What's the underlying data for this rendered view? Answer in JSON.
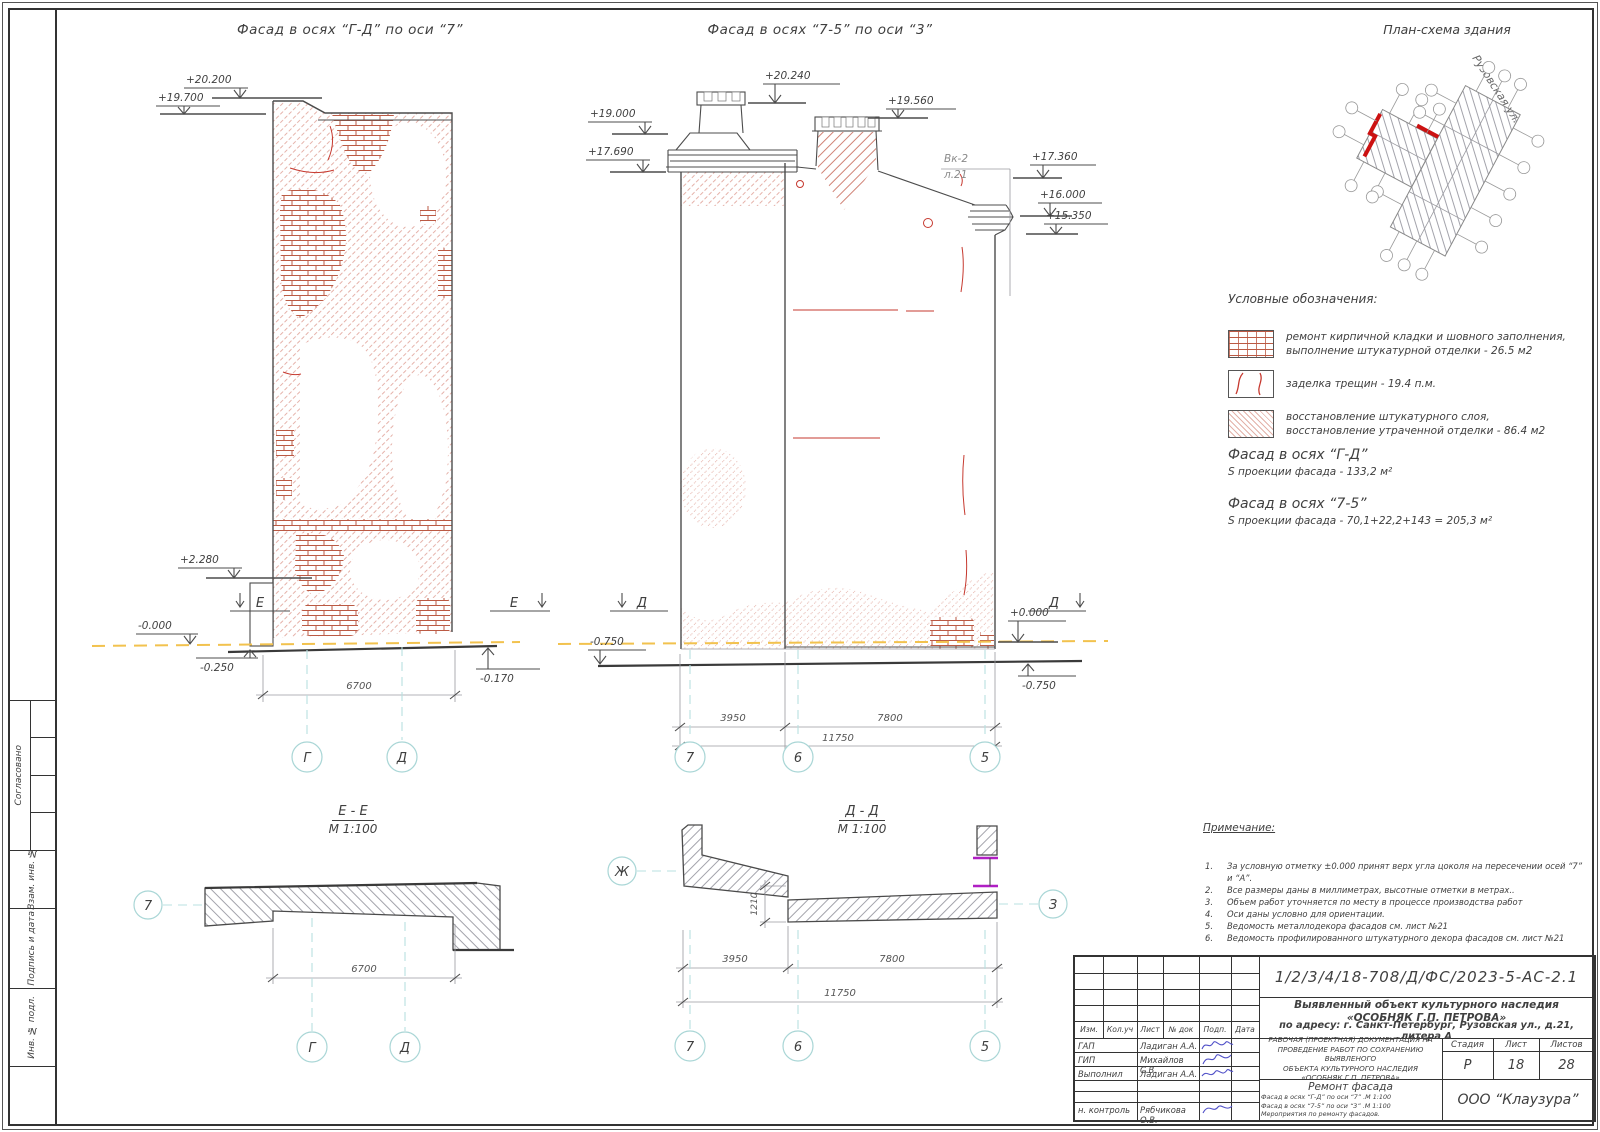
{
  "side": {
    "approved": "Согласовано",
    "vzam": "Взам. инв. №",
    "podpis": "Подпись и дата",
    "inv": "Инв. № подл."
  },
  "titles": {
    "facade_gd": "Фасад  в осях “Г-Д” по оси “7”",
    "facade_75": "Фасад  в осях “7-5” по оси “3”",
    "plan": "План-схема здания",
    "street": "Рузовская ул."
  },
  "facade_gd": {
    "e1": "+20.200",
    "e2": "+19.700",
    "e3": "+2.280",
    "e4": "-0.000",
    "e5": "-0.250",
    "e6": "-0.170",
    "dim": "6700",
    "axis1": "Г",
    "axis2": "Д",
    "sec": "Е"
  },
  "facade_75": {
    "e1": "+20.240",
    "e2": "+19.560",
    "e3": "+19.000",
    "e4": "+17.690",
    "e5": "+17.360",
    "e6": "+16.000",
    "e7": "+15.350",
    "e8": "+0.000",
    "e9": "-0.750",
    "e10": "-0.750",
    "vk1": "Вк-2",
    "vk2": "л.21",
    "d1": "3950",
    "d2": "7800",
    "dt": "11750",
    "a1": "7",
    "a2": "6",
    "a3": "5",
    "sec": "Д"
  },
  "section_ee": {
    "title": "Е - Е",
    "scale": "М 1:100",
    "dim": "6700",
    "axl": "7",
    "ax1": "Г",
    "ax2": "Д"
  },
  "section_dd": {
    "title": "Д - Д",
    "scale": "М 1:100",
    "step": "1210",
    "d1": "3950",
    "d2": "7800",
    "dt": "11750",
    "axl": "Ж",
    "axr": "З",
    "a1": "7",
    "a2": "6",
    "a3": "5"
  },
  "legend": {
    "heading": "Условные обозначения:",
    "item1_line1": "ремонт кирпичной кладки и шовного заполнения,",
    "item1_line2": "выполнение штукатурной отделки - 26.5 м2",
    "item2": "заделка трещин - 19.4 п.м.",
    "item3_line1": "восстановление штукатурного слоя,",
    "item3_line2": "восстановление утраченной отделки - 86.4 м2"
  },
  "areas": {
    "b1_title": "Фасад в осях “Г-Д”",
    "b1_value": "S проекции фасада - 133,2 м²",
    "b2_title": "Фасад в осях “7-5”",
    "b2_value": "S проекции фасада - 70,1+22,2+143 = 205,3 м²"
  },
  "notes": {
    "heading": "Примечание:",
    "nums": [
      "1.",
      "2.",
      "3.",
      "4.",
      "5.",
      "6."
    ],
    "items": [
      "За условную отметку ±0.000 принят верх угла цоколя на пересечении осей “7” и “А”.",
      "Все размеры даны в миллиметрах, высотные отметки в метрах..",
      "Объем работ уточняется по месту в процессе производства работ",
      "Оси даны условно для ориентации.",
      "Ведомость металлодекора фасадов см. лист №21",
      "Ведомость профилированного штукатурного декора фасадов см. лист №21"
    ]
  },
  "titleblock": {
    "doc_number": "1/2/3/4/18-708/Д/ФС/2023-5-АС-2.1",
    "object_line1": "Выявленный объект культурного наследия",
    "object_line2": "«ОСОБНЯК Г.П. ПЕТРОВА»",
    "object_line3": "по адресу: г. Санкт-Петербург, Рузовская ул., д.21, литера А",
    "cols": {
      "izm": "Изм.",
      "koluch": "Кол.уч",
      "list": "Лист",
      "ndok": "№ док",
      "podp": "Подп.",
      "data": "Дата"
    },
    "rows": [
      {
        "role": "ГАП",
        "name": "Ладиган А.А."
      },
      {
        "role": "ГИП",
        "name": "Михайлов С.В."
      },
      {
        "role": "Выполнил",
        "name": "Ладиган А.А."
      },
      {
        "role": "н. контроль",
        "name": "Рябчикова О.В."
      }
    ],
    "desc_line1": "РАБОЧАЯ (ПРОЕКТНАЯ) ДОКУМЕНТАЦИЯ НА",
    "desc_line2": "ПРОВЕДЕНИЕ РАБОТ ПО СОХРАНЕНИЮ ВЫЯВЛЕНОГО",
    "desc_line3": "ОБЪЕКТА КУЛЬТУРНОГО НАСЛЕДИЯ",
    "desc_line4": "«ОСОБНЯК Г.П. ПЕТРОВА»",
    "stage_label": "Стадия",
    "sheet_label": "Лист",
    "sheets_label": "Листов",
    "stage": "Р",
    "sheet": "18",
    "sheets": "28",
    "work_title": "Ремонт фасада",
    "work_line1": "Фасад  в осях “Г-Д” по оси “7” .М 1:100",
    "work_line2": "Фасад  в осях “7-5” по оси “3” .М 1:100",
    "work_line3": "Мероприятия по ремонту фасадов.",
    "company": "ООО “Клаузура”"
  }
}
